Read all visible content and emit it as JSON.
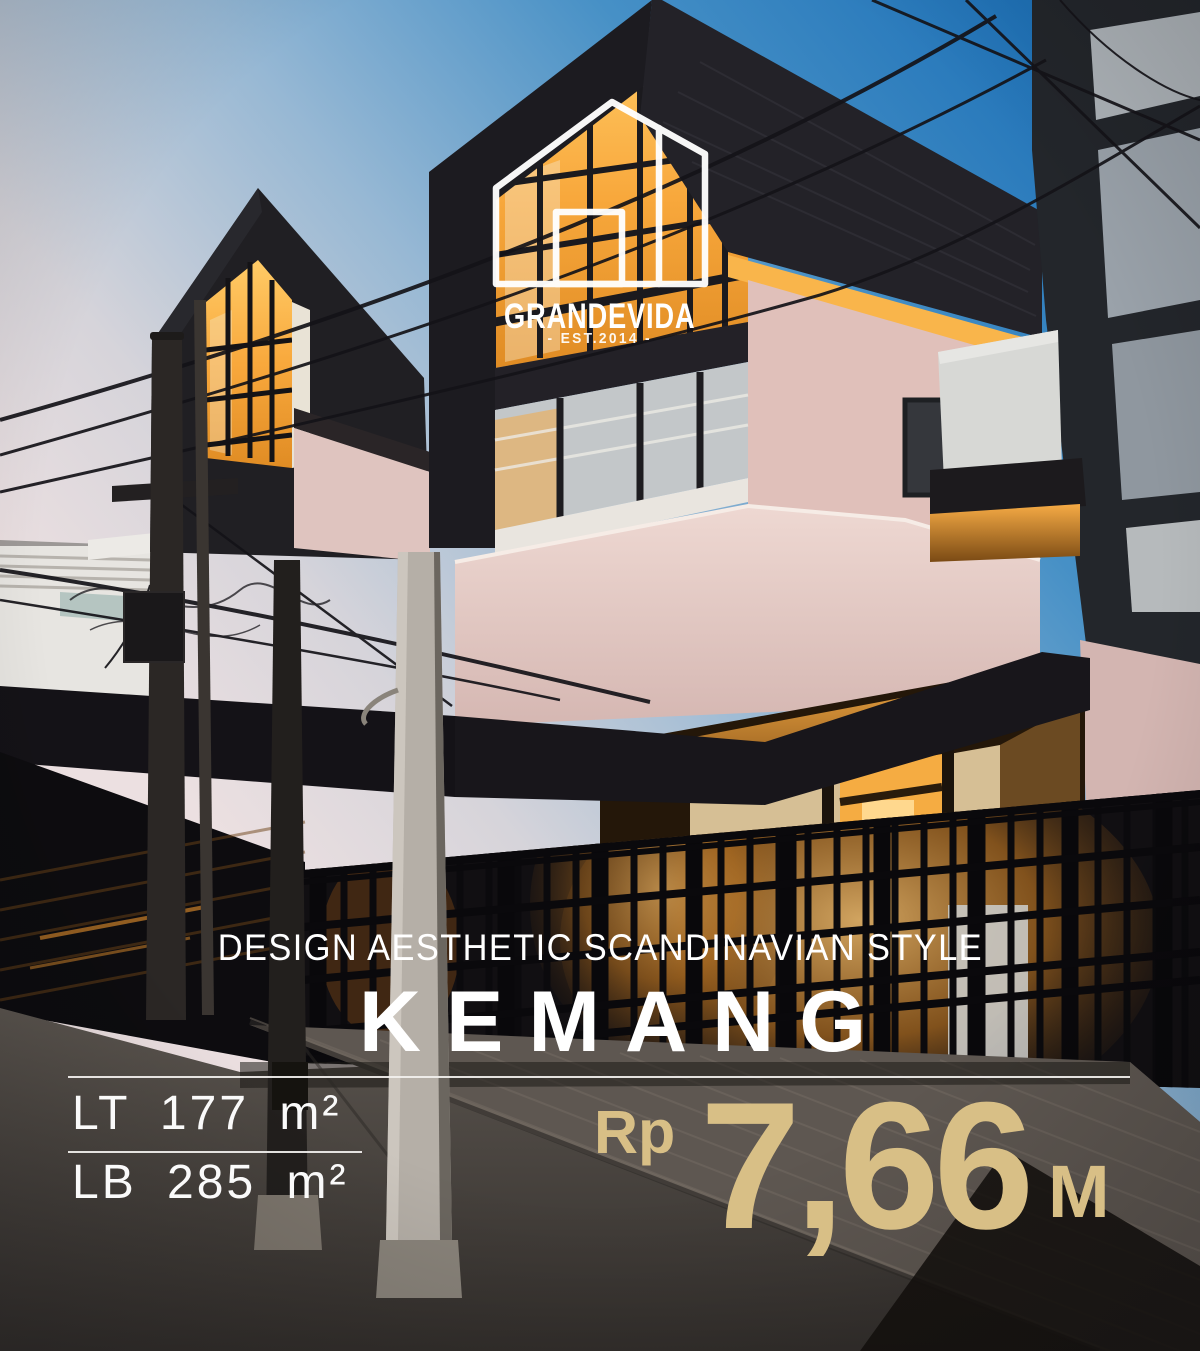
{
  "brand": {
    "name": "GRANDEVIDA",
    "established": "- EST.2014 -"
  },
  "headline": {
    "tagline": "DESIGN AESTHETIC SCANDINAVIAN STYLE",
    "location": "KEMANG"
  },
  "specs": {
    "land_area": "LT 177 m²",
    "building_area": "LB 285 m²"
  },
  "price": {
    "currency": "Rp",
    "amount": "7,66",
    "unit": "M"
  },
  "colors": {
    "accent_gold": "#d8bf86",
    "text_white": "#ffffff",
    "sky_blue": "#2e7cbe",
    "wall_pink": "#e2c5c0",
    "window_glow": "#f6a83e"
  },
  "photo": {
    "description": "Modern Scandinavian-style townhouses at dusk: steep black gable roofs, blush pink walls, glowing amber windows, black grid fence, utility poles and cables over a paved street"
  }
}
